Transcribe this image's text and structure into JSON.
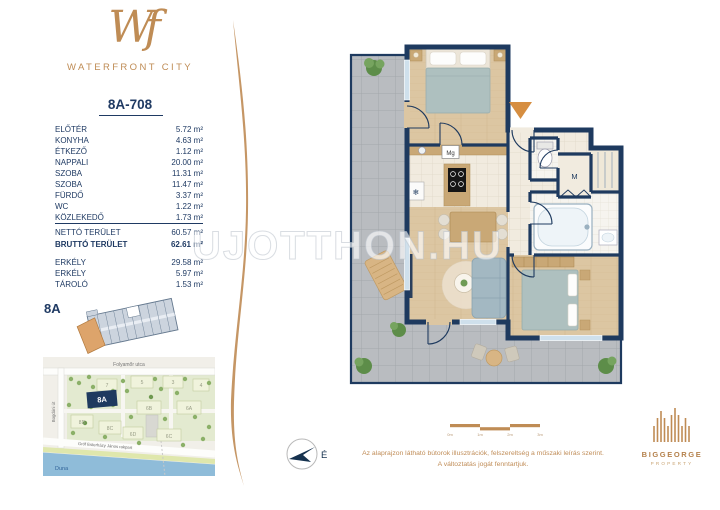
{
  "brand": {
    "monogram": "Wf",
    "name": "WATERFRONT CITY"
  },
  "unit": {
    "id": "8A-708",
    "rooms": [
      {
        "name": "ELŐTÉR",
        "area": "5.72 m²"
      },
      {
        "name": "KONYHA",
        "area": "4.63 m²"
      },
      {
        "name": "ÉTKEZŐ",
        "area": "1.12 m²"
      },
      {
        "name": "NAPPALI",
        "area": "20.00 m²"
      },
      {
        "name": "SZOBA",
        "area": "11.31 m²"
      },
      {
        "name": "SZOBA",
        "area": "11.47 m²"
      },
      {
        "name": "FÜRDŐ",
        "area": "3.37 m²"
      },
      {
        "name": "WC",
        "area": "1.22 m²"
      },
      {
        "name": "KÖZLEKEDŐ",
        "area": "1.73 m²"
      }
    ],
    "totals": [
      {
        "name": "NETTÓ TERÜLET",
        "area": "60.57 m²"
      },
      {
        "name": "BRUTTÓ TERÜLET",
        "area": "62.61 m²"
      }
    ],
    "extras": [
      {
        "name": "ERKÉLY",
        "area": "29.58 m²"
      },
      {
        "name": "ERKÉLY",
        "area": "5.97 m²"
      },
      {
        "name": "TÁROLÓ",
        "area": "1.53 m²"
      }
    ]
  },
  "keyplan": {
    "label": "8A"
  },
  "map": {
    "streets": {
      "top": "Folyamőr utca",
      "left": "Bogdáni út",
      "embankment": "Gróf Esterházy János rakpart",
      "river": "Duna"
    },
    "highlight": "8A",
    "buildings": [
      "7",
      "5",
      "3",
      "4",
      "6B",
      "6A",
      "8D",
      "8C",
      "6D",
      "6C"
    ]
  },
  "floorplan": {
    "watermark": "UJOTTHON.HU",
    "labels": {
      "washing_machine": "Mg",
      "wardrobe": "M",
      "fridge": "❄"
    }
  },
  "footer": {
    "north_label": "É",
    "scale_labels": [
      "0m",
      "1m",
      "2m",
      "3m"
    ],
    "disclaimer_line1": "Az alaprajzon látható bútorok illusztrációk, felszereltség a műszaki leírás szerint.",
    "disclaimer_line2": "A változtatás jogát fenntartjuk.",
    "publisher": {
      "name": "BIGGEORGE",
      "sub": "PROPERTY"
    }
  },
  "colors": {
    "accent": "#bf8c55",
    "navy": "#1f3a63",
    "wall": "#1e3a5f",
    "wood": "#dcc6a2",
    "terrace": "#b9bcc0",
    "river": "#8fbcd9",
    "map_green": "#e3ead0",
    "entry_arrow": "#d68e41"
  }
}
